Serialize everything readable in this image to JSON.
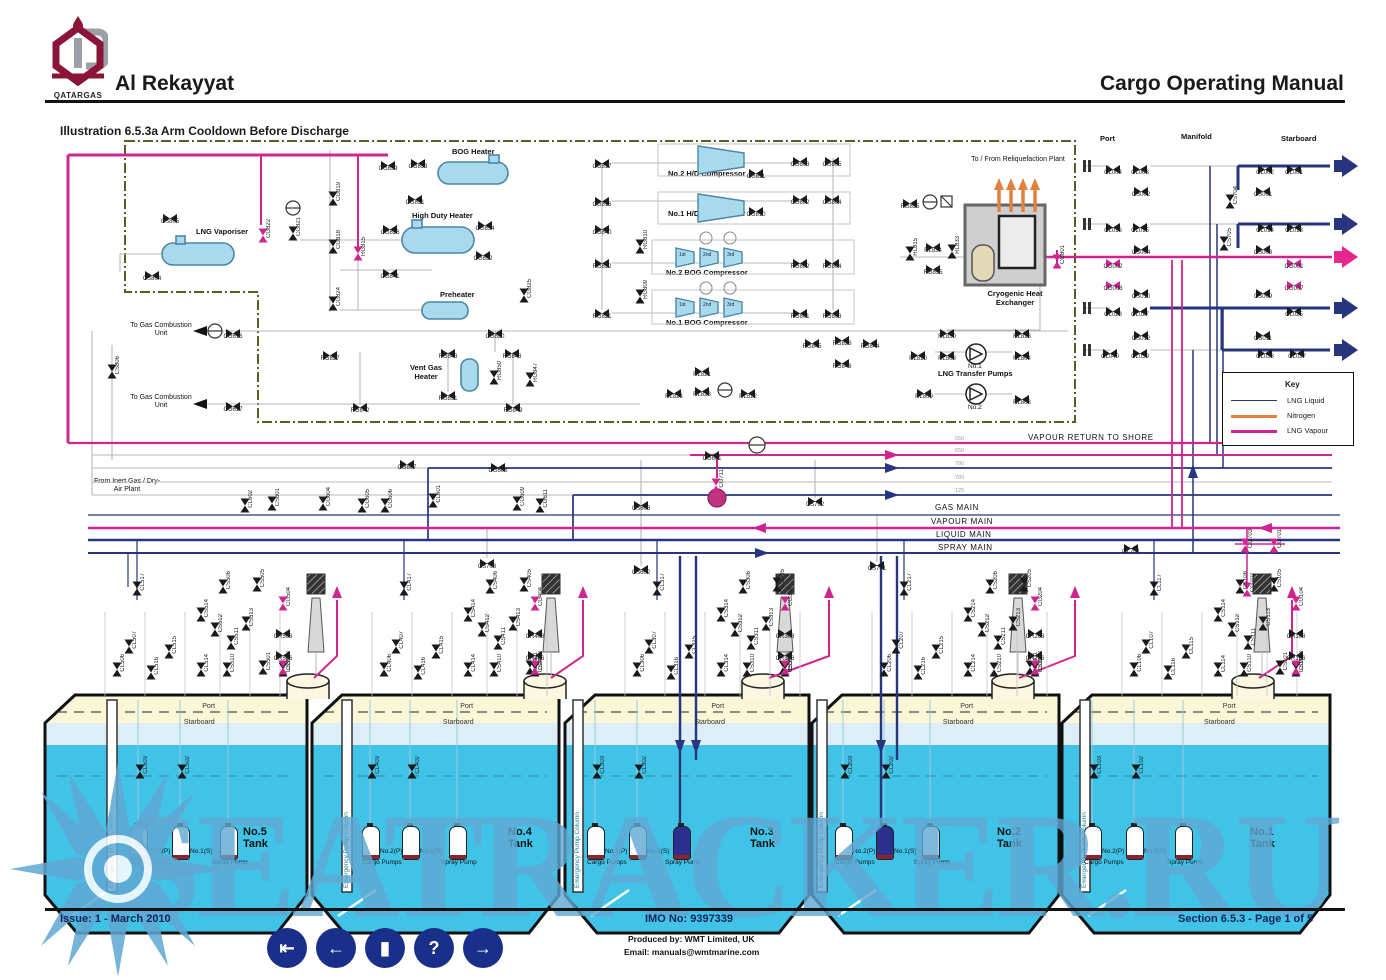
{
  "header": {
    "logo_text": "QATARGAS",
    "ship_name": "Al Rekayyat",
    "manual_title": "Cargo Operating Manual",
    "illustration_title": "Illustration 6.5.3a Arm Cooldown Before Discharge"
  },
  "equipment": {
    "lng_vaporiser": "LNG Vaporiser",
    "bog_heater": "BOG Heater",
    "high_duty_heater": "High Duty Heater",
    "preheater": "Preheater",
    "vent_gas_heater": "Vent Gas Heater",
    "hd2": "No.2 H/D Compressor",
    "hd1": "No.1 H/D Compressor",
    "bog2": "No.2 BOG Compressor",
    "bog1": "No.1 BOG Compressor",
    "stages": [
      "1st",
      "2nd",
      "3rd"
    ],
    "cold_box": "Cold Box",
    "separator": "Separator",
    "cryo_hx": "Cryogenic Heat Exchanger",
    "reliq": "To / From Reliquefaction Plant",
    "transfer_pumps": "LNG Transfer Pumps",
    "pump_no1": "No.1",
    "pump_no2": "No.2",
    "to_gcu": "To Gas Combustion Unit",
    "from_inert": "From Inert Gas / Dry-Air Plant"
  },
  "mains": {
    "vapour_return": "VAPOUR RETURN TO SHORE",
    "gas": "GAS MAIN",
    "vapour": "VAPOUR MAIN",
    "liquid": "LIQUID MAIN",
    "spray": "SPRAY MAIN",
    "sizes": [
      "650",
      "650",
      "700",
      "700",
      "125"
    ]
  },
  "manifold": {
    "port": "Port",
    "manifold": "Manifold",
    "starboard": "Starboard"
  },
  "key": {
    "title": "Key",
    "entries": [
      {
        "label": "LNG Liquid",
        "color": "#26357d"
      },
      {
        "label": "Nitrogen",
        "color": "#e0813f"
      },
      {
        "label": "LNG Vapour",
        "color": "#cf2590"
      }
    ]
  },
  "diagram": {
    "plant_valves": [
      [
        "CS805",
        170,
        215,
        "h"
      ],
      [
        "CS804",
        152,
        272,
        "h"
      ],
      [
        "CG822",
        263,
        232,
        "v",
        "p"
      ],
      [
        "CG821",
        293,
        230,
        "v"
      ],
      [
        "CG819",
        333,
        195,
        "v"
      ],
      [
        "CG818",
        333,
        243,
        "v"
      ],
      [
        "CG824",
        333,
        300,
        "v"
      ],
      [
        "RG815",
        358,
        250,
        "v",
        "p"
      ],
      [
        "CG839",
        388,
        162,
        "h"
      ],
      [
        "CG833",
        418,
        160,
        "h"
      ],
      [
        "CG831",
        415,
        196,
        "h"
      ],
      [
        "CG826",
        390,
        226,
        "h"
      ],
      [
        "CG834",
        485,
        222,
        "h"
      ],
      [
        "CG832",
        483,
        252,
        "h"
      ],
      [
        "CG841",
        390,
        270,
        "h"
      ],
      [
        "CG825",
        524,
        292,
        "v"
      ],
      [
        "CG820",
        495,
        330,
        "h"
      ],
      [
        "CG616",
        233,
        330,
        "h"
      ],
      [
        "CG617",
        233,
        403,
        "h"
      ],
      [
        "CS806",
        112,
        368,
        "v"
      ],
      [
        "RG827",
        330,
        352,
        "h"
      ],
      [
        "RG843",
        448,
        350,
        "h"
      ],
      [
        "RG848",
        512,
        350,
        "h"
      ],
      [
        "RG850",
        494,
        374,
        "v"
      ],
      [
        "RG847",
        530,
        376,
        "v"
      ],
      [
        "RG851",
        448,
        392,
        "h"
      ],
      [
        "RG842",
        360,
        404,
        "h"
      ],
      [
        "RG849",
        513,
        404,
        "h"
      ],
      [
        "CG817",
        602,
        160,
        "h"
      ],
      [
        "CG811",
        756,
        170,
        "h"
      ],
      [
        "CG803",
        800,
        158,
        "h"
      ],
      [
        "CG805",
        832,
        158,
        "h"
      ],
      [
        "CG816",
        602,
        198,
        "h"
      ],
      [
        "CG810",
        756,
        208,
        "h"
      ],
      [
        "CG802",
        800,
        196,
        "h"
      ],
      [
        "CG804",
        832,
        196,
        "h"
      ],
      [
        "CG840",
        602,
        226,
        "h"
      ],
      [
        "RG822",
        602,
        260,
        "h"
      ],
      [
        "RG810",
        640,
        243,
        "v"
      ],
      [
        "RG802",
        800,
        260,
        "h"
      ],
      [
        "RG804",
        832,
        260,
        "h"
      ],
      [
        "RG821",
        602,
        310,
        "h"
      ],
      [
        "RG809",
        640,
        293,
        "v"
      ],
      [
        "RG801",
        800,
        310,
        "h"
      ],
      [
        "RG803",
        832,
        310,
        "h"
      ],
      [
        "RG845",
        812,
        340,
        "h"
      ],
      [
        "RG826",
        842,
        337,
        "h"
      ],
      [
        "RG844",
        870,
        340,
        "h"
      ],
      [
        "RG846",
        842,
        360,
        "h"
      ],
      [
        "RL821",
        702,
        368,
        "h"
      ],
      [
        "RL824",
        674,
        390,
        "h"
      ],
      [
        "RL823",
        702,
        388,
        "h"
      ],
      [
        "RL822",
        748,
        390,
        "h"
      ],
      [
        "RG825",
        910,
        200,
        "h"
      ],
      [
        "RL815",
        910,
        250,
        "v"
      ],
      [
        "RL834",
        933,
        244,
        "h"
      ],
      [
        "RL833",
        952,
        248,
        "v"
      ],
      [
        "RG835",
        933,
        266,
        "h"
      ],
      [
        "CG801",
        1057,
        258,
        "v",
        "p"
      ],
      [
        "RL830",
        947,
        330,
        "h"
      ],
      [
        "RL813",
        1022,
        330,
        "h"
      ],
      [
        "RL810",
        918,
        352,
        "h"
      ],
      [
        "RL808",
        947,
        352,
        "h"
      ],
      [
        "RL804",
        1022,
        352,
        "h"
      ],
      [
        "RL809",
        924,
        390,
        "h"
      ],
      [
        "RL803",
        1022,
        396,
        "h"
      ],
      [
        "CG601",
        712,
        452,
        "h"
      ],
      [
        "CG711",
        716,
        482,
        "v",
        "p"
      ],
      [
        "CS603",
        641,
        502,
        "h"
      ],
      [
        "CS602",
        641,
        566,
        "h"
      ],
      [
        "CS702",
        815,
        498,
        "h"
      ],
      [
        "CS701",
        877,
        562,
        "h"
      ],
      [
        "CS703",
        487,
        560,
        "h"
      ],
      [
        "CG607",
        407,
        461,
        "h"
      ],
      [
        "CG608",
        498,
        464,
        "h"
      ],
      [
        "CL602",
        245,
        502,
        "v"
      ],
      [
        "CS601",
        272,
        500,
        "v"
      ],
      [
        "CG604",
        323,
        500,
        "v"
      ],
      [
        "CG605",
        362,
        502,
        "v"
      ],
      [
        "CG606",
        385,
        502,
        "v"
      ],
      [
        "CL601",
        433,
        497,
        "v"
      ],
      [
        "CG609",
        517,
        500,
        "v"
      ],
      [
        "CG611",
        540,
        502,
        "v"
      ],
      [
        "CL701",
        1131,
        545,
        "h"
      ],
      [
        "CG703",
        1245,
        542,
        "v",
        "p"
      ],
      [
        "CG701",
        1274,
        542,
        "v",
        "p"
      ],
      [
        "CG702",
        1247,
        586,
        "v",
        "p"
      ]
    ],
    "manifold_valves": [
      [
        "CL004",
        1113,
        166,
        "h"
      ],
      [
        "CL003",
        1140,
        166,
        "h"
      ],
      [
        "CS002",
        1141,
        188,
        "h"
      ],
      [
        "CS704",
        1230,
        198,
        "v"
      ],
      [
        "CL002",
        1265,
        166,
        "h"
      ],
      [
        "CL001",
        1294,
        166,
        "h"
      ],
      [
        "CS001",
        1263,
        188,
        "h"
      ],
      [
        "CL016",
        1113,
        224,
        "h"
      ],
      [
        "CL015",
        1140,
        224,
        "h"
      ],
      [
        "CS004",
        1141,
        246,
        "h"
      ],
      [
        "CS705",
        1224,
        240,
        "v"
      ],
      [
        "CL014",
        1265,
        224,
        "h"
      ],
      [
        "CL013",
        1294,
        224,
        "h"
      ],
      [
        "CS003",
        1263,
        246,
        "h"
      ],
      [
        "CG002",
        1113,
        260,
        "h",
        "p"
      ],
      [
        "CG008",
        1113,
        282,
        "h",
        "p"
      ],
      [
        "CG001",
        1294,
        260,
        "h",
        "p"
      ],
      [
        "CG007",
        1294,
        282,
        "h",
        "p"
      ],
      [
        "CS010",
        1141,
        290,
        "h"
      ],
      [
        "CL028",
        1113,
        308,
        "h"
      ],
      [
        "CL027",
        1140,
        308,
        "h"
      ],
      [
        "CS009",
        1263,
        290,
        "h"
      ],
      [
        "CL025",
        1294,
        308,
        "h"
      ],
      [
        "CS012",
        1141,
        332,
        "h"
      ],
      [
        "CL040",
        1110,
        350,
        "h"
      ],
      [
        "CL039",
        1140,
        350,
        "h"
      ],
      [
        "CS011",
        1263,
        332,
        "h"
      ],
      [
        "CL038",
        1265,
        350,
        "h"
      ],
      [
        "CL037",
        1297,
        350,
        "h"
      ]
    ],
    "cluster_template": [
      [
        "CL%17",
        92,
        585,
        "v"
      ],
      [
        "CS%06",
        178,
        583,
        "v"
      ],
      [
        "CS%05",
        212,
        581,
        "v"
      ],
      [
        "CL%07",
        84,
        643,
        "v"
      ],
      [
        "CL%06",
        72,
        666,
        "v"
      ],
      [
        "CL%15",
        124,
        648,
        "v"
      ],
      [
        "CL%16",
        106,
        669,
        "v"
      ],
      [
        "CS%14",
        156,
        611,
        "v"
      ],
      [
        "CS%12",
        170,
        626,
        "v"
      ],
      [
        "CS%11",
        186,
        639,
        "v"
      ],
      [
        "CS%13",
        201,
        620,
        "v"
      ],
      [
        "CL%14",
        156,
        666,
        "v"
      ],
      [
        "CS%10",
        182,
        666,
        "v"
      ],
      [
        "CS%01",
        218,
        664,
        "v"
      ],
      [
        "CS%02",
        246,
        666,
        "v"
      ],
      [
        "CR%08",
        258,
        630,
        "h"
      ],
      [
        "CR%06",
        268,
        652,
        "h"
      ],
      [
        "CG%04",
        291,
        600,
        "v",
        "p"
      ],
      [
        "CG%03",
        291,
        664,
        "v",
        "p"
      ]
    ],
    "tank_labels": {
      "column": "Emergency Pump Column",
      "pump1": "No.2(P)",
      "pump2": "No.1(S)",
      "cargo": "Cargo Pumps",
      "spray": "Spray Pump",
      "port": "Port",
      "starboard": "Starboard",
      "inner_valve1": "CL%03",
      "inner_valve2": "CL%02"
    },
    "tanks": [
      {
        "num": 5,
        "name": "No.5 Tank",
        "left": 45,
        "width": 262,
        "col_x": 112,
        "p1": 138,
        "p2": 180,
        "spray": 228,
        "name_x": 243,
        "dome": 308,
        "mast": 316,
        "pink": 337,
        "dark": ""
      },
      {
        "num": 4,
        "name": "No.4 Tank",
        "left": 312,
        "width": 247,
        "col_x": 347,
        "p1": 370,
        "p2": 410,
        "spray": 457,
        "name_x": 508,
        "dome": 545,
        "mast": 551,
        "pink": 583,
        "dark": ""
      },
      {
        "num": 3,
        "name": "No.3 Tank",
        "left": 565,
        "width": 244,
        "col_x": 578,
        "p1": 595,
        "p2": 637,
        "spray": 681,
        "name_x": 750,
        "dome": 763,
        "mast": 785,
        "pink": 829,
        "dark": "spray"
      },
      {
        "num": 2,
        "name": "No.2 Tank",
        "left": 812,
        "width": 247,
        "col_x": 822,
        "p1": 843,
        "p2": 884,
        "spray": 930,
        "name_x": 997,
        "dome": 1013,
        "mast": 1018,
        "pink": 1075,
        "dark": "p2"
      },
      {
        "num": 1,
        "name": "No.1 Tank",
        "left": 1062,
        "width": 268,
        "col_x": 1085,
        "p1": 1092,
        "p2": 1134,
        "spray": 1183,
        "name_x": 1250,
        "dome": 1253,
        "mast": 1262,
        "pink": 1292,
        "dark": ""
      }
    ]
  },
  "watermark": {
    "text": "SEATRACKER.RU"
  },
  "footer": {
    "issue": "Issue: 1  -  March 2010",
    "imo": "IMO No: 9397339",
    "produced_by": "Produced by: WMT Limited, UK",
    "email": "Email: manuals@wmtmarine.com",
    "section": "Section 6.5.3  -  Page 1 of 5",
    "nav_icons": [
      "first",
      "back",
      "contents",
      "help",
      "next"
    ],
    "nav_glyphs": [
      "⇤",
      "←",
      "▮",
      "?",
      "→"
    ]
  }
}
